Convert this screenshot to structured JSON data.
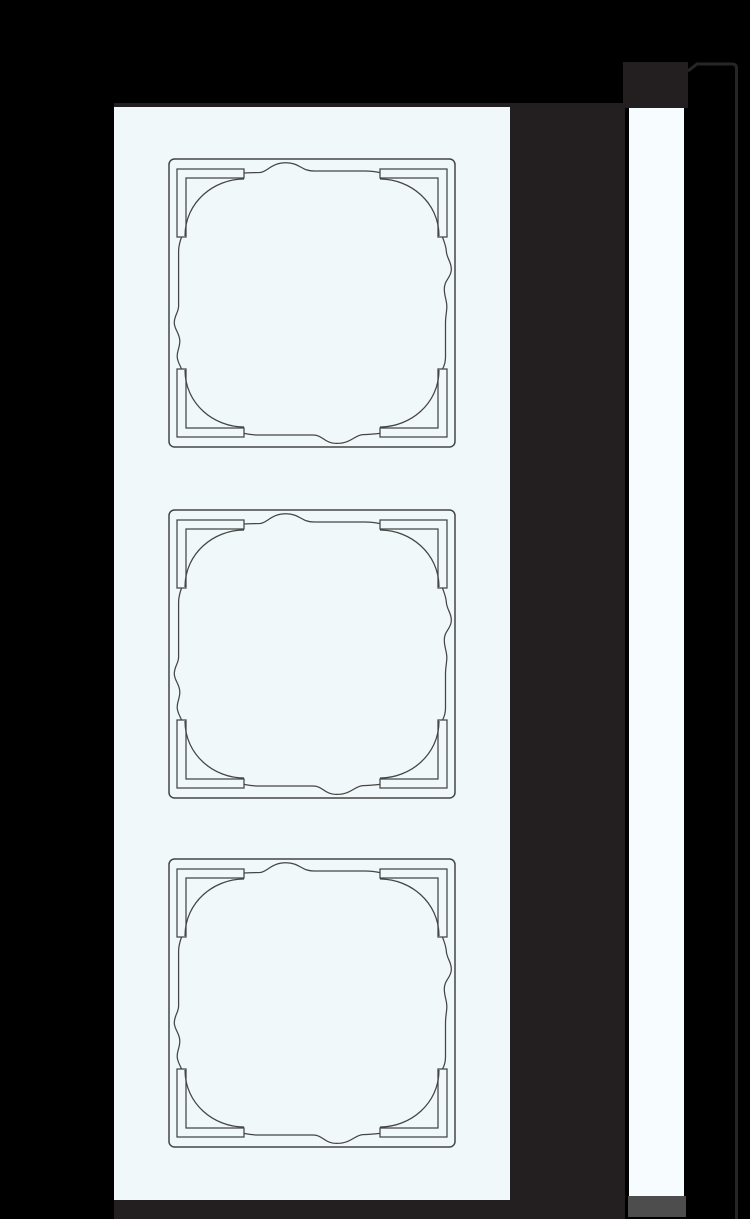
{
  "image": {
    "type": "technical line drawing",
    "subject": "3-gang switch frame: front view with three square openings and side profile view",
    "openings_count": 3,
    "text_content": "none"
  },
  "labels": {
    "stage": "Product drawing on black background",
    "shadow_block": "Dark backing strip behind frame",
    "front_panel": "Front view of 3-gang frame",
    "opening_1": "Frame opening 1 (top)",
    "opening_2": "Frame opening 2 (middle)",
    "opening_3": "Frame opening 3 (bottom)",
    "profile_tab": "Side profile top section",
    "side_strip": "Side profile of frame",
    "side_cap": "Side profile base cap",
    "profile_outline": "Thin side profile outline"
  },
  "colors": {
    "background": "#000000",
    "panel": "#f1f8f9",
    "line": "#454545",
    "shadow": "#231f20",
    "strip": "#f7fdfe",
    "cap": "#4d4d4d",
    "profile": "#262626"
  }
}
